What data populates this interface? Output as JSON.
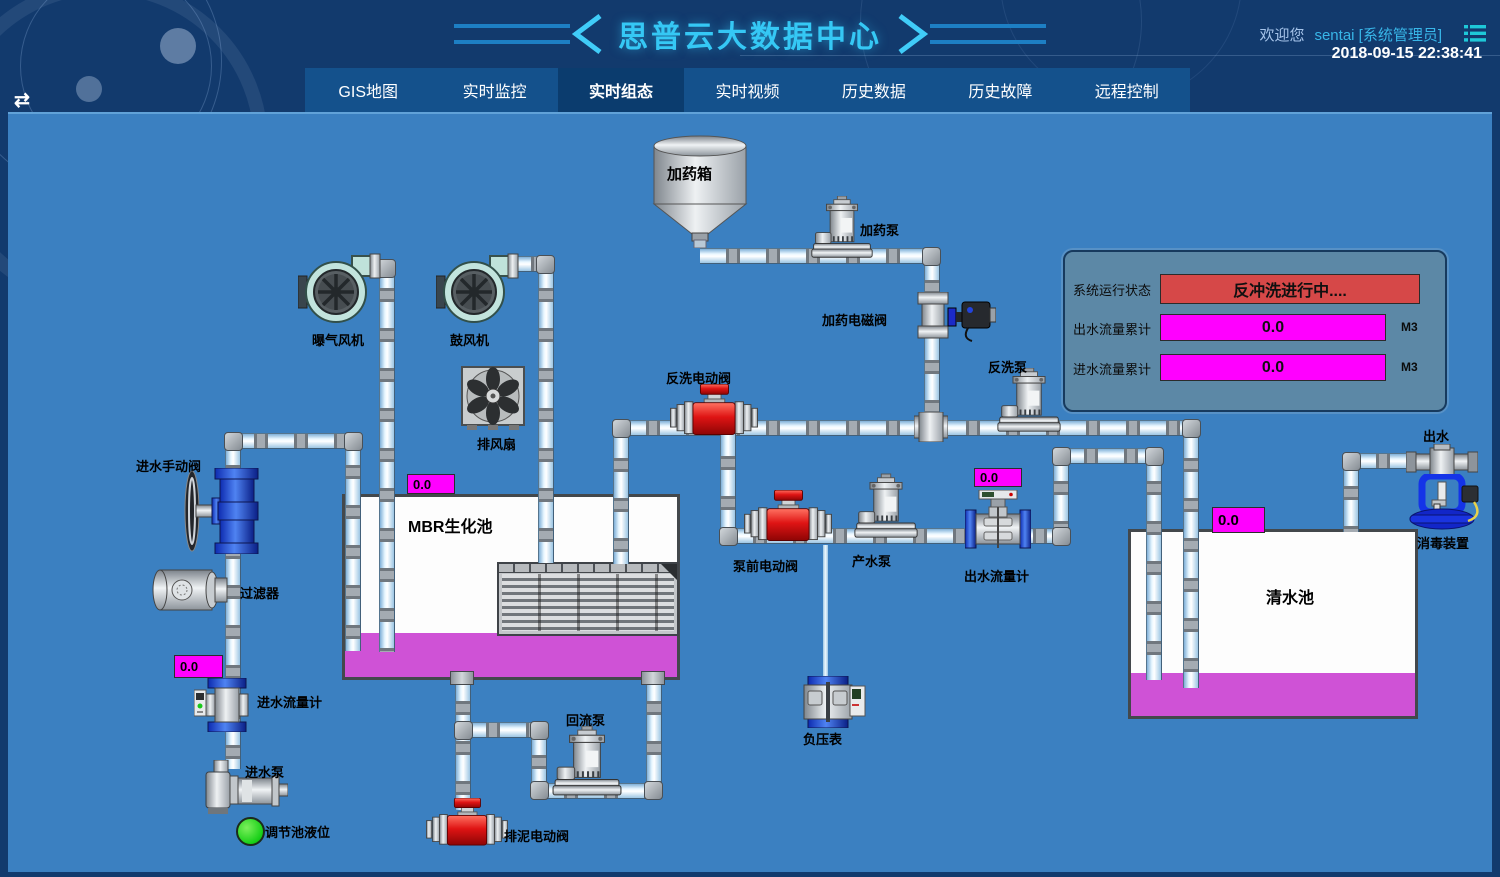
{
  "header": {
    "title": "思普云大数据中心",
    "welcome": "欢迎您",
    "user": "sentai [系统管理员]",
    "datetime": "2018-09-15 22:38:41"
  },
  "nav": {
    "active_tab": "实时组态",
    "tabs": [
      {
        "label": "GIS地图"
      },
      {
        "label": "实时监控"
      },
      {
        "label": "实时组态"
      },
      {
        "label": "实时视频"
      },
      {
        "label": "历史数据"
      },
      {
        "label": "历史故障"
      },
      {
        "label": "远程控制"
      }
    ]
  },
  "status_panel": {
    "system_status_label": "系统运行状态",
    "system_status_value": "反冲洗进行中....",
    "outlet_total_label": "出水流量累计",
    "outlet_total_value": "0.0",
    "outlet_total_unit": "M3",
    "inlet_total_label": "进水流量累计",
    "inlet_total_value": "0.0",
    "inlet_total_unit": "M3"
  },
  "diagram": {
    "labels": {
      "dosing_tank": "加药箱",
      "dosing_pump": "加药泵",
      "dosing_valve": "加药电磁阀",
      "aeration_blower": "曝气风机",
      "blower": "鼓风机",
      "exhaust_fan": "排风扇",
      "backwash_valve": "反洗电动阀",
      "backwash_pump": "反洗泵",
      "inlet_manual_valve": "进水手动阀",
      "filter": "过滤器",
      "mbr_tank": "MBR生化池",
      "inlet_flowmeter": "进水流量计",
      "inlet_pump": "进水泵",
      "regulating_level": "调节池液位",
      "sludge_valve": "排泥电动阀",
      "reflux_pump": "回流泵",
      "prepump_valve": "泵前电动阀",
      "product_pump": "产水泵",
      "outlet_flowmeter": "出水流量计",
      "vacuum_gauge": "负压表",
      "clean_tank": "清水池",
      "outlet": "出水",
      "disinfection": "消毒装置"
    },
    "values": {
      "mbr_level": "0.0",
      "inlet_flow": "0.0",
      "outlet_flow": "0.0",
      "clean_level": "0.0"
    }
  },
  "colors": {
    "main_bg": "#3b80c1",
    "header_bg": "#123a6d",
    "nav_bg": "#14518c",
    "nav_active": "#0b3c6e",
    "accent_cyan": "#35c8f5",
    "alarm_red": "#d64848",
    "value_magenta": "#ff00ff",
    "liquid_magenta": "#cf52d6",
    "panel_slate": "#5c88a6"
  }
}
